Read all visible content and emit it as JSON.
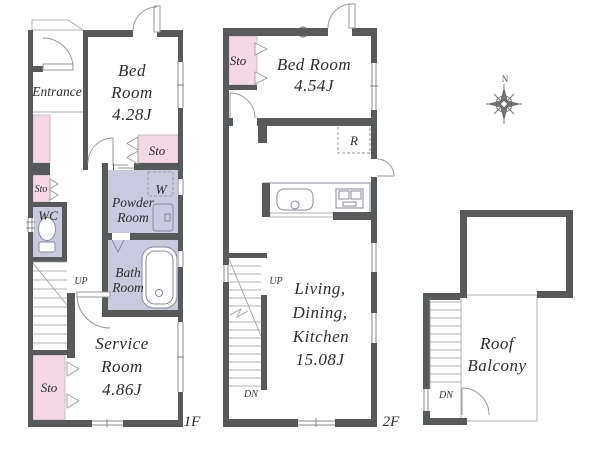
{
  "compass": {
    "north_label": "N"
  },
  "floor1": {
    "floor_label": "1F",
    "entrance_label": "Entrance",
    "bedroom_lines": [
      "Bed",
      "Room",
      "4.28J"
    ],
    "bedroom_storage_label": "Sto",
    "hall_storage_label": "Sto",
    "service_storage_label": "Sto",
    "wc_label": "WC",
    "powder_lines": [
      "Powder",
      "Room"
    ],
    "washer_label": "W",
    "bath_lines": [
      "Bath",
      "Room"
    ],
    "service_lines": [
      "Service",
      "Room",
      "4.86J"
    ],
    "stairs_up_label": "UP"
  },
  "floor2": {
    "floor_label": "2F",
    "storage_label": "Sto",
    "bedroom_lines": [
      "Bed Room",
      "4.54J"
    ],
    "refrigerator_label": "R",
    "ldk_lines": [
      "Living,",
      "Dining,",
      "Kitchen",
      "15.08J"
    ],
    "stairs_up_label": "UP",
    "stairs_down_label": "DN"
  },
  "roof": {
    "balcony_lines": [
      "Roof",
      "Balcony"
    ],
    "stairs_down_label": "DN"
  },
  "colors": {
    "wall": "#58595b",
    "storage_pink": "#f3d9e5",
    "wet_area_lavender": "#c9cade",
    "outline_gray": "#9b9b9b",
    "text": "#2e2e2e"
  }
}
